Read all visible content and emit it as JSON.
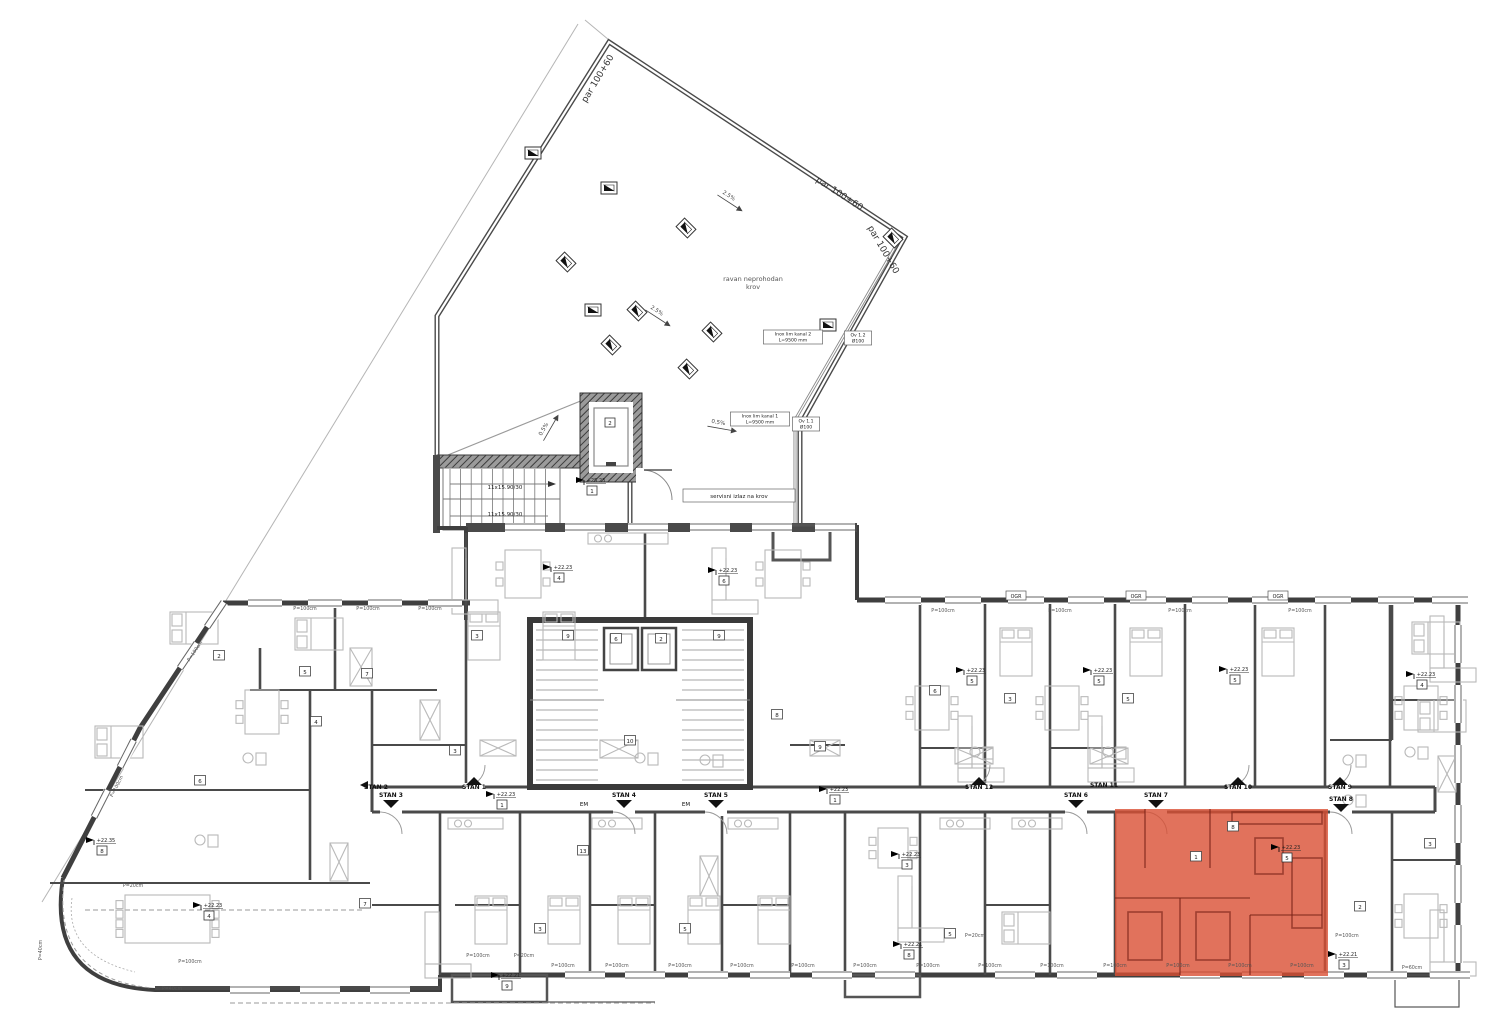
{
  "drawing": {
    "highlight_color": "#d94f33",
    "wall_color": "#3f3f3f",
    "parcel_labels": [
      {
        "text": "par 100+60",
        "x": 600,
        "y": 80,
        "rot": -59
      },
      {
        "text": "par 100+60",
        "x": 838,
        "y": 196,
        "rot": 33
      },
      {
        "text": "par 100+60",
        "x": 881,
        "y": 251,
        "rot": 60
      }
    ],
    "roof": {
      "area_label_lines": [
        "ravan neprohodan",
        "krov"
      ],
      "area_label_x": 753,
      "area_label_y": 281,
      "slope_labels": [
        {
          "text": "2.5%",
          "x": 728,
          "y": 197,
          "rot": 33
        },
        {
          "text": "2.5%",
          "x": 656,
          "y": 312,
          "rot": 33
        },
        {
          "text": "0.5%",
          "x": 718,
          "y": 424,
          "rot": 10
        },
        {
          "text": "0.5%",
          "x": 545,
          "y": 430,
          "rot": -60
        }
      ]
    },
    "callouts": [
      {
        "lines": [
          "Inox lim kanal 2",
          "L=9500 mm"
        ],
        "x": 793,
        "y": 336
      },
      {
        "lines": [
          "Ov 1.2",
          "Ø100"
        ],
        "x": 858,
        "y": 337
      },
      {
        "lines": [
          "Inox lim kanal 1",
          "L=9500 mm"
        ],
        "x": 760,
        "y": 418
      },
      {
        "lines": [
          "Ov 1.1",
          "Ø100"
        ],
        "x": 806,
        "y": 423
      }
    ],
    "stair": {
      "flight_labels": [
        {
          "text": "11x15.90/30",
          "x": 505,
          "y": 489
        },
        {
          "text": "11x15.90/30",
          "x": 505,
          "y": 516
        }
      ],
      "service_exit": {
        "text": "servisni izlaz na krov",
        "x": 739,
        "y": 496
      },
      "elevator_number": "2",
      "elevator_box_x": 610,
      "elevator_box_y": 424
    },
    "apartments": [
      {
        "label": "STAN 2",
        "x": 376,
        "y": 789,
        "dir": "left"
      },
      {
        "label": "STAN 3",
        "x": 391,
        "y": 797,
        "dir": "down"
      },
      {
        "label": "STAN 1",
        "x": 474,
        "y": 789,
        "dir": "up"
      },
      {
        "label": "STAN 4",
        "x": 624,
        "y": 797,
        "dir": "down"
      },
      {
        "label": "STAN 5",
        "x": 716,
        "y": 797,
        "dir": "down"
      },
      {
        "label": "STAN 12",
        "x": 979,
        "y": 789,
        "dir": "up"
      },
      {
        "label": "STAN 6",
        "x": 1076,
        "y": 797,
        "dir": "down"
      },
      {
        "label": "STAN 11",
        "x": 1104,
        "y": 787,
        "dir": "none"
      },
      {
        "label": "STAN 7",
        "x": 1156,
        "y": 797,
        "dir": "down"
      },
      {
        "label": "STAN 10",
        "x": 1238,
        "y": 789,
        "dir": "up"
      },
      {
        "label": "STAN 9",
        "x": 1340,
        "y": 789,
        "dir": "up"
      },
      {
        "label": "STAN 8",
        "x": 1341,
        "y": 801,
        "dir": "down"
      }
    ],
    "levels": [
      {
        "level": "+25.23",
        "room": "1",
        "x": 585,
        "y": 481
      },
      {
        "level": "+22.23",
        "room": "4",
        "x": 552,
        "y": 568
      },
      {
        "level": "+22.23",
        "room": "6",
        "x": 717,
        "y": 571
      },
      {
        "level": "+22.23",
        "room": "4",
        "x": 202,
        "y": 906
      },
      {
        "level": "+22.23",
        "room": "1",
        "x": 495,
        "y": 795
      },
      {
        "level": "+22.23",
        "room": "1",
        "x": 828,
        "y": 790
      },
      {
        "level": "+22.23",
        "room": "5",
        "x": 965,
        "y": 671
      },
      {
        "level": "+22.23",
        "room": "5",
        "x": 1092,
        "y": 671
      },
      {
        "level": "+22.23",
        "room": "5",
        "x": 1228,
        "y": 670
      },
      {
        "level": "+22.23",
        "room": "4",
        "x": 1415,
        "y": 675
      },
      {
        "level": "+22.23",
        "room": "5",
        "x": 1280,
        "y": 848
      },
      {
        "level": "+22.23",
        "room": "3",
        "x": 900,
        "y": 855
      },
      {
        "level": "+22.21",
        "room": "9",
        "x": 500,
        "y": 976
      },
      {
        "level": "+22.21",
        "room": "8",
        "x": 902,
        "y": 945
      },
      {
        "level": "+22.21",
        "room": "3",
        "x": 1337,
        "y": 955
      },
      {
        "level": "+22.35",
        "room": "8",
        "x": 95,
        "y": 841
      }
    ],
    "room_numbers": [
      {
        "n": "2",
        "x": 219,
        "y": 657
      },
      {
        "n": "5",
        "x": 305,
        "y": 673
      },
      {
        "n": "7",
        "x": 367,
        "y": 675
      },
      {
        "n": "4",
        "x": 316,
        "y": 723
      },
      {
        "n": "6",
        "x": 200,
        "y": 782
      },
      {
        "n": "3",
        "x": 455,
        "y": 752
      },
      {
        "n": "10",
        "x": 630,
        "y": 742
      },
      {
        "n": "8",
        "x": 777,
        "y": 716
      },
      {
        "n": "9",
        "x": 820,
        "y": 748
      },
      {
        "n": "3",
        "x": 477,
        "y": 637
      },
      {
        "n": "6",
        "x": 935,
        "y": 692
      },
      {
        "n": "3",
        "x": 1010,
        "y": 700
      },
      {
        "n": "9",
        "x": 568,
        "y": 637
      },
      {
        "n": "6",
        "x": 616,
        "y": 640
      },
      {
        "n": "2",
        "x": 661,
        "y": 640
      },
      {
        "n": "9",
        "x": 719,
        "y": 637
      },
      {
        "n": "1",
        "x": 1196,
        "y": 858
      },
      {
        "n": "8",
        "x": 1233,
        "y": 828
      },
      {
        "n": "7",
        "x": 365,
        "y": 905
      },
      {
        "n": "3",
        "x": 540,
        "y": 930
      },
      {
        "n": "5",
        "x": 685,
        "y": 930
      },
      {
        "n": "5",
        "x": 950,
        "y": 935
      },
      {
        "n": "2",
        "x": 1360,
        "y": 908
      },
      {
        "n": "3",
        "x": 1430,
        "y": 845
      },
      {
        "n": "5",
        "x": 1128,
        "y": 700
      },
      {
        "n": "13",
        "x": 583,
        "y": 852
      }
    ],
    "window_labels": [
      {
        "text": "P=100cm",
        "x": 563,
        "y": 967
      },
      {
        "text": "P=100cm",
        "x": 617,
        "y": 967
      },
      {
        "text": "P=100cm",
        "x": 680,
        "y": 967
      },
      {
        "text": "P=100cm",
        "x": 742,
        "y": 967
      },
      {
        "text": "P=100cm",
        "x": 803,
        "y": 967
      },
      {
        "text": "P=100cm",
        "x": 865,
        "y": 967
      },
      {
        "text": "P=100cm",
        "x": 928,
        "y": 967
      },
      {
        "text": "P=100cm",
        "x": 990,
        "y": 967
      },
      {
        "text": "P=100cm",
        "x": 1052,
        "y": 967
      },
      {
        "text": "P=100cm",
        "x": 1115,
        "y": 967
      },
      {
        "text": "P=100cm",
        "x": 1178,
        "y": 967
      },
      {
        "text": "P=100cm",
        "x": 1240,
        "y": 967
      },
      {
        "text": "P=100cm",
        "x": 1302,
        "y": 967
      },
      {
        "text": "P=100cm",
        "x": 1347,
        "y": 937
      },
      {
        "text": "P=100cm",
        "x": 478,
        "y": 957
      },
      {
        "text": "P=20cm",
        "x": 524,
        "y": 957
      },
      {
        "text": "P=20cm",
        "x": 133,
        "y": 887
      },
      {
        "text": "P=20cm",
        "x": 975,
        "y": 937
      },
      {
        "text": "P=40cm",
        "x": 172,
        "y": 990
      },
      {
        "text": "P=40cm",
        "x": 42,
        "y": 950,
        "rot": -90
      },
      {
        "text": "P=60cm",
        "x": 1412,
        "y": 969
      },
      {
        "text": "P=100cm",
        "x": 190,
        "y": 963
      },
      {
        "text": "P=100cm",
        "x": 305,
        "y": 610
      },
      {
        "text": "P=100cm",
        "x": 368,
        "y": 610
      },
      {
        "text": "P=100cm",
        "x": 430,
        "y": 610
      },
      {
        "text": "P=100cm",
        "x": 943,
        "y": 612
      },
      {
        "text": "P=100cm",
        "x": 1060,
        "y": 612
      },
      {
        "text": "P=100cm",
        "x": 1180,
        "y": 612
      },
      {
        "text": "P=100cm",
        "x": 1300,
        "y": 612
      },
      {
        "text": "P=100cm",
        "x": 196,
        "y": 652,
        "rot": -56
      },
      {
        "text": "P=100cm",
        "x": 118,
        "y": 787,
        "rot": -63
      }
    ],
    "ogr_labels": [
      {
        "text": "OGR",
        "x": 1016,
        "y": 597
      },
      {
        "text": "OGR",
        "x": 1136,
        "y": 597
      },
      {
        "text": "OGR",
        "x": 1278,
        "y": 597
      }
    ],
    "em_labels": [
      {
        "text": "EM",
        "x": 584,
        "y": 806
      },
      {
        "text": "EM",
        "x": 686,
        "y": 806
      }
    ]
  }
}
